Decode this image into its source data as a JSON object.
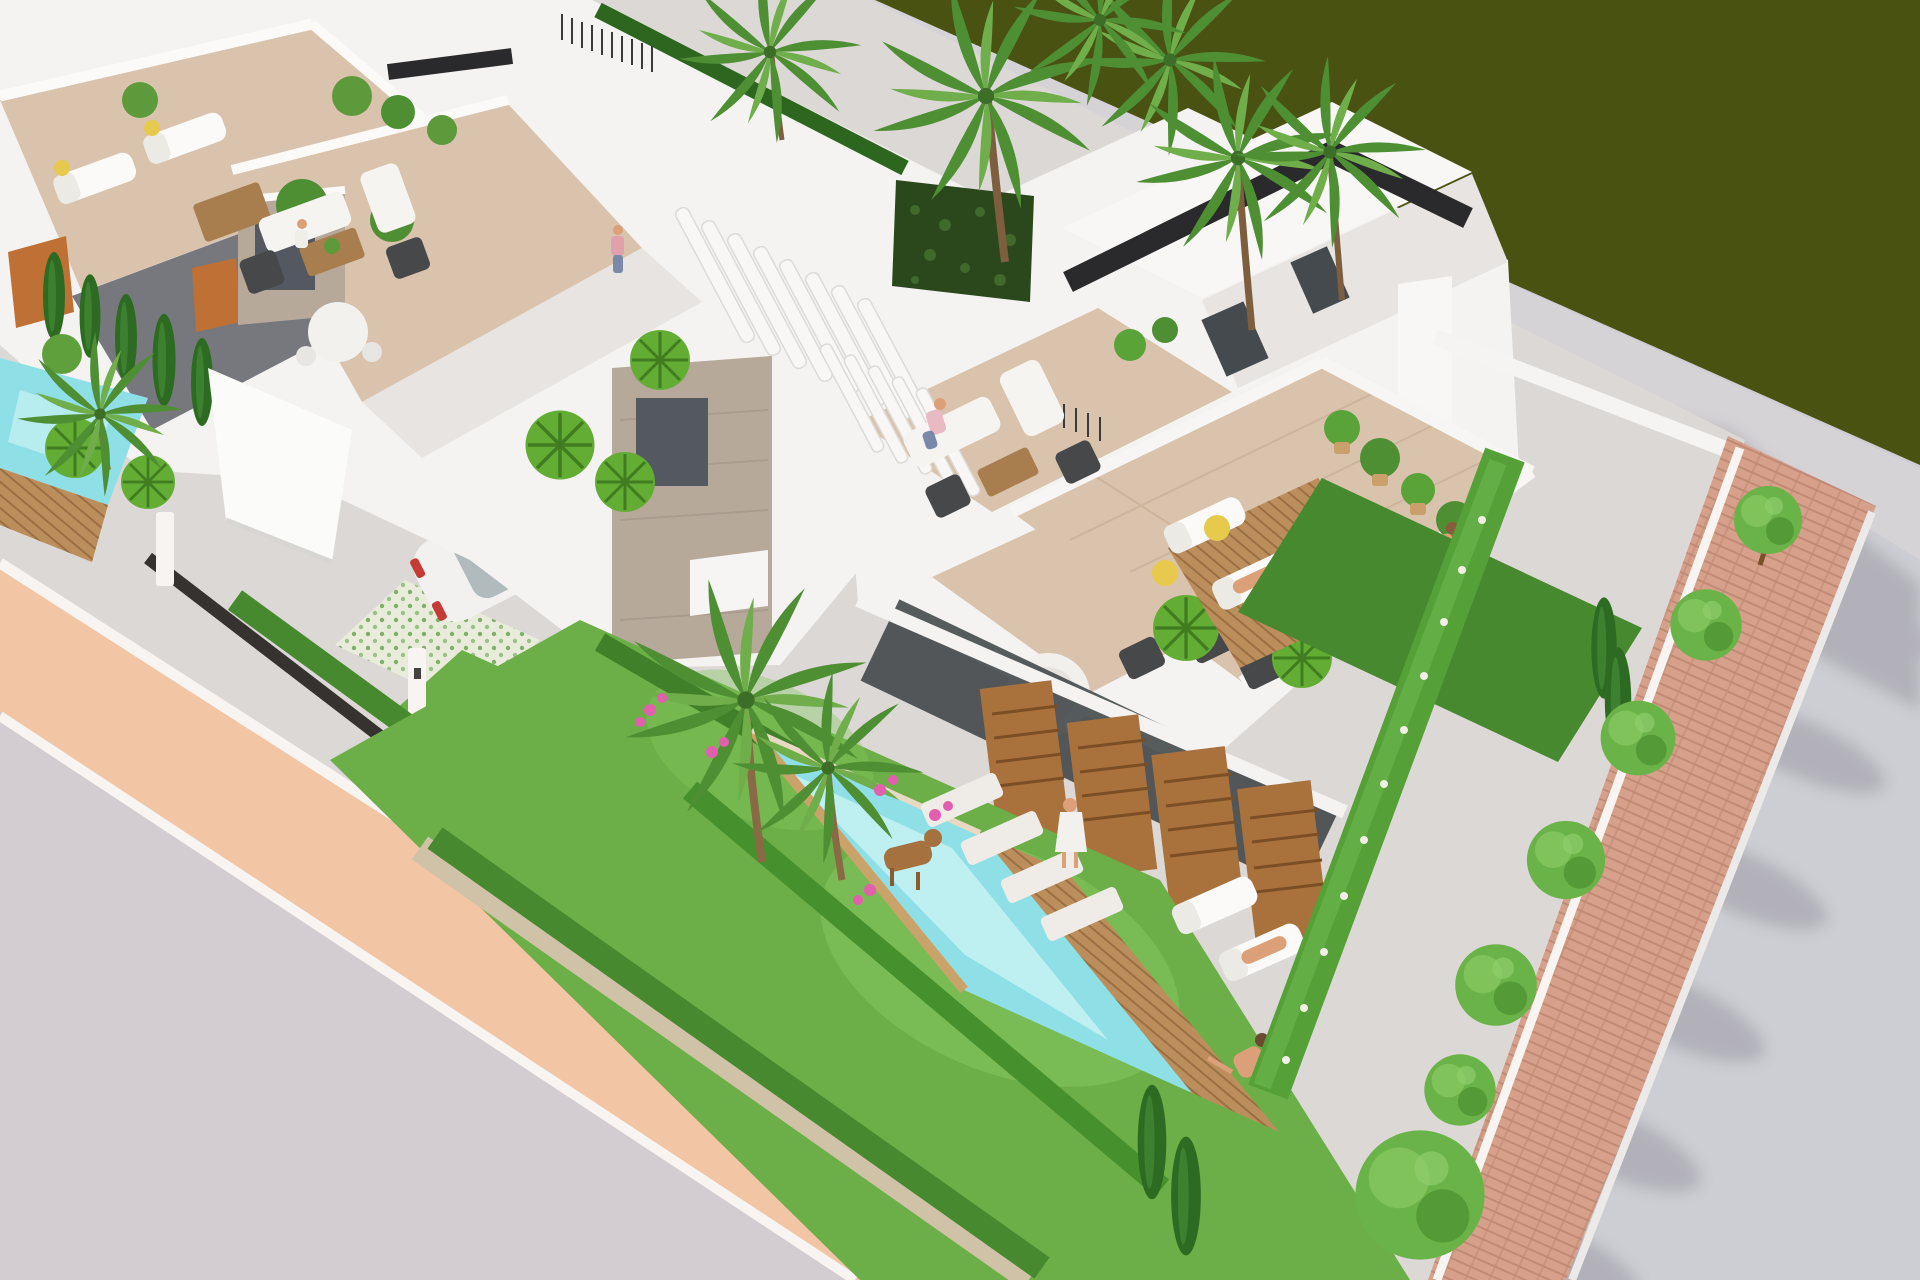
{
  "meta": {
    "description": "Aerial 3D architectural rendering of a modern white villa development with rooftop terraces, private gardens, swimming pools, palm trees and a tree-lined street",
    "render_width": 1920,
    "render_height": 1280
  },
  "palette": {
    "ground": "#cdced3",
    "road_tint": "#d3ccd0",
    "olive_field": "#4a5212",
    "walkway": "#d6d3d7",
    "shadow": "#8e8a96",
    "plot": "#dcd8d6",
    "sidewalk": "#f2c5a4",
    "curb": "#f7f4f1",
    "lawn": "#6cae47",
    "lawn_light": "#85c75f",
    "hedge": "#47892f",
    "hedge_dark": "#2c661f",
    "gravel": "#cfc2a6",
    "cypress": "#2e6b22",
    "tree": "#6ab348",
    "tree_light": "#82c65e",
    "tree_dark": "#4e9232",
    "palm": "#4e8f34",
    "palm_light": "#6fae4a",
    "trunk": "#7d5f40",
    "pool": "#8fdfe6",
    "pool_light": "#c9f2f4",
    "deck_wood": "#bc8e5c",
    "slat_wood": "#a9713c",
    "slat_wood_dark": "#7c4e24",
    "wall": "#f4f3f1",
    "wall_light": "#f8f7f5",
    "wall_shade": "#e7e4e1",
    "wall_dark": "#77787e",
    "dark_band": "#2a292b",
    "glass": "#454a4e",
    "terrace": "#d9c3ac",
    "terrace_line": "#cdb49c",
    "stone": "#b7a99a",
    "grille": "#545860",
    "skin": "#dba077",
    "accent_yellow": "#e7c94b",
    "flower_pink": "#e25fae",
    "brick": "#d7a08b",
    "brick_line": "#c08a75",
    "car_white": "#f2f1ef",
    "car_dark": "#2f3337",
    "fence": "#35322f",
    "yoga_mat": "#2e2e30",
    "furniture_wood": "#a97e4f",
    "furniture_dark": "#47484a",
    "vertical_garden": "#2b481d",
    "terracotta_slats": "#bf7034",
    "tile_pattern_bg": "#e9ecdb",
    "tile_pattern_dot": "#7fae6b"
  },
  "scene": {
    "areas": {
      "olive_field_label": "dark green field strip",
      "promenade_label": "rear promenade with palm shadows",
      "road_label": "access road",
      "sidewalk_label": "salmon sidewalk with white curbs",
      "parkway_label": "tree-lined brick parkway",
      "garden_label": "front garden with lawn and pool",
      "left_garden_label": "neighbour garden with pool"
    },
    "objects": {
      "villas_visible": 3,
      "rooftop_terraces": 4,
      "swimming_pools": 2,
      "cars": 2,
      "people": 9,
      "sun_loungers": 6,
      "parkway_trees": 7,
      "palm_trees": 7,
      "stone_chimneys": 2,
      "wooden_privacy_screens": 4,
      "pergolas": 2
    }
  }
}
